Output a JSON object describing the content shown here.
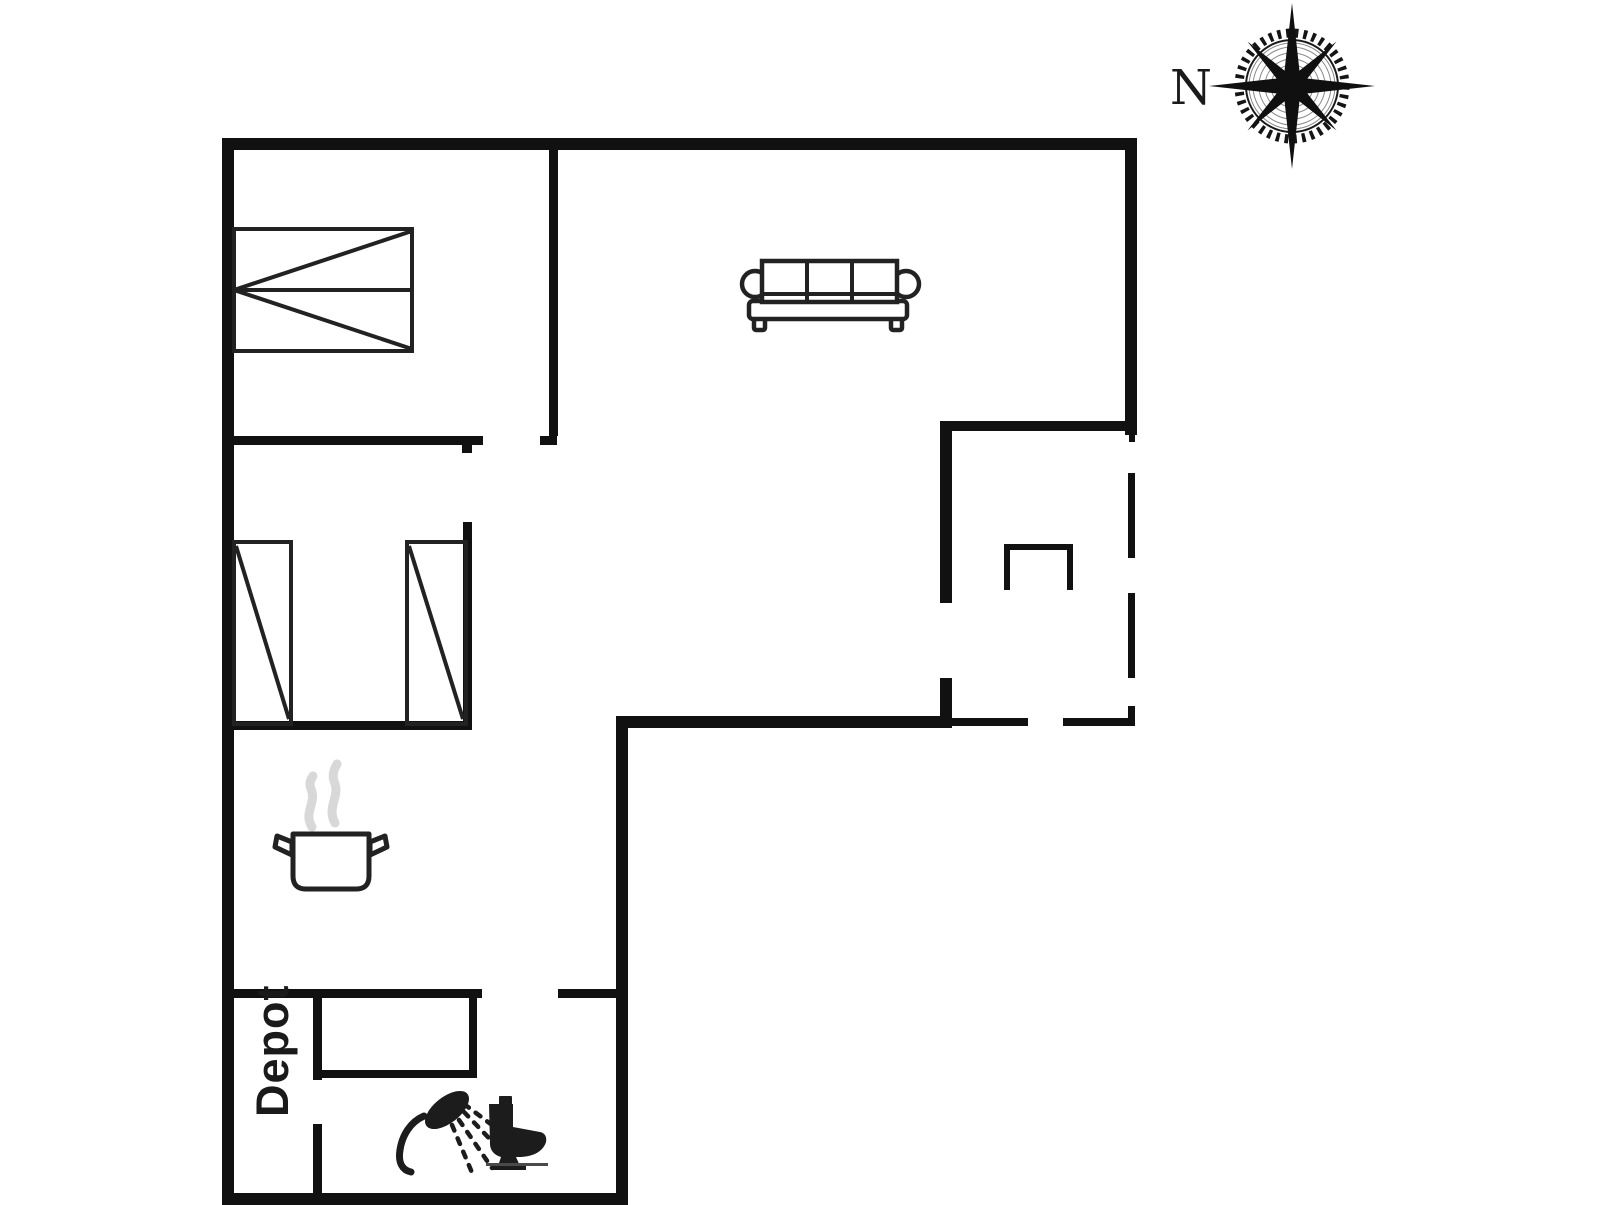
{
  "labels": {
    "depot": "Depot",
    "compass_north": "N"
  },
  "colors": {
    "wall": "#111111",
    "furniture": "#222222",
    "icon": "#1c1c1c",
    "steam": "#d8d8d8",
    "text": "#1a1a1a",
    "background": "#ffffff"
  },
  "icons": [
    {
      "name": "compass-rose-icon",
      "depicts": "compass rose pointing north"
    },
    {
      "name": "double-bed-icon",
      "depicts": "double bed"
    },
    {
      "name": "single-bed-icon",
      "depicts": "single bed"
    },
    {
      "name": "sofa-icon",
      "depicts": "three-seat sofa"
    },
    {
      "name": "cooking-pot-icon",
      "depicts": "steaming cooking pot (kitchen)"
    },
    {
      "name": "shower-icon",
      "depicts": "hand shower with spray"
    },
    {
      "name": "toilet-icon",
      "depicts": "toilet"
    }
  ]
}
